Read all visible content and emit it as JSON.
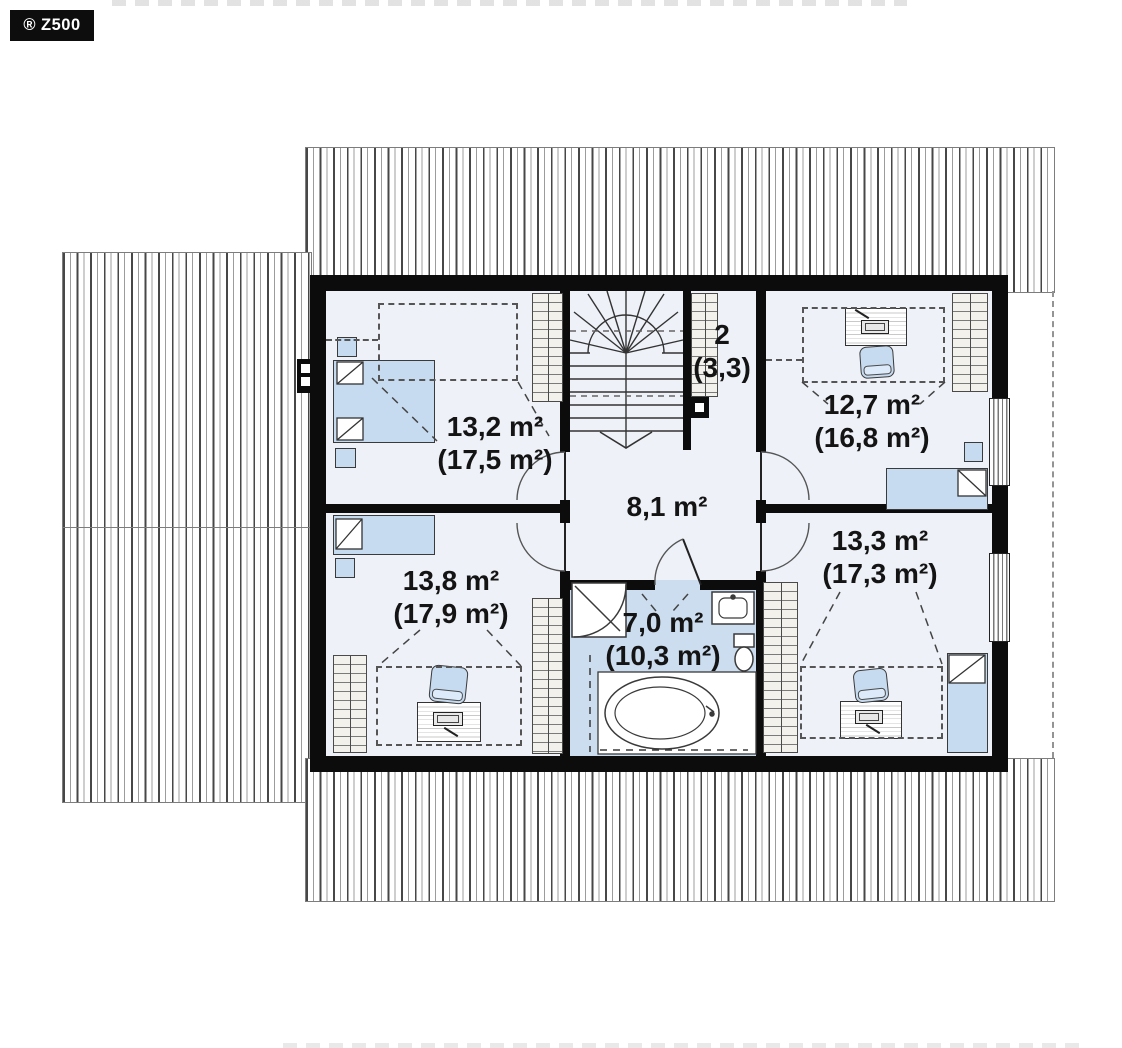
{
  "brand": {
    "label": "® Z500"
  },
  "rooms": {
    "bedroom_top_left": {
      "area": "13,2 m²",
      "total": "(17,5 m²)"
    },
    "storage": {
      "number": "2",
      "total": "(3,3)"
    },
    "bedroom_top_right": {
      "area": "12,7 m²",
      "total": "(16,8 m²)"
    },
    "hall": {
      "area": "8,1 m²"
    },
    "bedroom_bottom_left": {
      "area": "13,8 m²",
      "total": "(17,9 m²)"
    },
    "bathroom": {
      "area": "7,0 m²",
      "total": "(10,3 m²)"
    },
    "bedroom_bottom_right": {
      "area": "13,3 m²",
      "total": "(17,3 m²)"
    }
  },
  "colors": {
    "wall": "#0c0c0c",
    "floor": "#eef1f8",
    "bath_floor": "#cbddee",
    "furniture_blue": "#c7dbf0"
  }
}
